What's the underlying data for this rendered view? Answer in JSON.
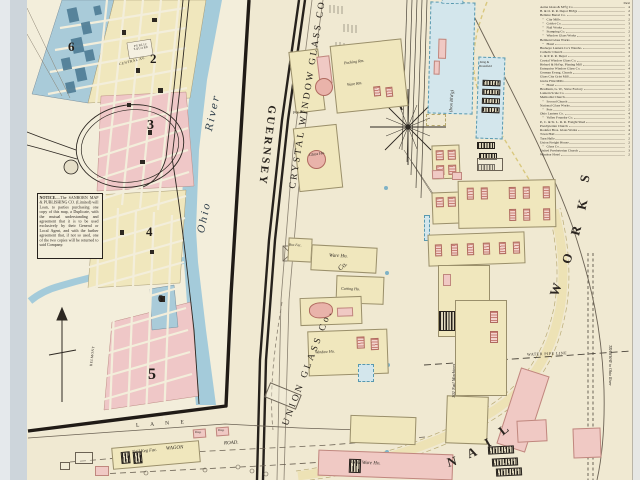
{
  "page": {
    "description": "Sanborn fire insurance map sheet, riverside industrial town with glass and nail works"
  },
  "index": {
    "header": "Sheet",
    "entries": [
      {
        "n": "Aetna Glass & M'f'g Co.",
        "s": "4"
      },
      {
        "n": "B. & O. R. R. Depot Bld'gs",
        "s": "2"
      },
      {
        "n": "Bellaire Barrel Co.",
        "s": "3"
      },
      {
        "n": "   ″   City Mills",
        "s": "2"
      },
      {
        "n": "   ″   Goblet Co.",
        "s": "3"
      },
      {
        "n": "   ″   Nail Works",
        "s": "1"
      },
      {
        "n": "   ″   Stamping Co.",
        "s": "2"
      },
      {
        "n": "   ″   Window Glass Works",
        "s": "1"
      },
      {
        "n": "Belmont Glass Works",
        "s": "2"
      },
      {
        "n": "   ″   Hotel",
        "s": "2"
      },
      {
        "n": "Buckeye Lantern Co's Wareho.",
        "s": "3"
      },
      {
        "n": "Catholic Church",
        "s": "3"
      },
      {
        "n": "C. & P. R. R. Depot",
        "s": "2"
      },
      {
        "n": "Crystal Window Glass Co.",
        "s": "1"
      },
      {
        "n": "Hebard & Hol'sp. Planing Mill",
        "s": "2"
      },
      {
        "n": "Enterprise Window Glass Co.",
        "s": "4"
      },
      {
        "n": "German Evang. Church",
        "s": "3"
      },
      {
        "n": "Glass City Grist Mill",
        "s": "2"
      },
      {
        "n": "Globe Flint Mills",
        "s": "3"
      },
      {
        "n": "   ″   Hotel",
        "s": "2"
      },
      {
        "n": "Bradburn, G. W., Stave Factory",
        "s": "3"
      },
      {
        "n": "Lantern Scale Co.",
        "s": "3"
      },
      {
        "n": "Methodist Church",
        "s": "3"
      },
      {
        "n": "   ″   Second Church",
        "s": "3"
      },
      {
        "n": "National Glass Works",
        "s": "2"
      },
      {
        "n": "   ″   Pots",
        "s": "2"
      },
      {
        "n": "Ohio Lantern Co.",
        "s": "4"
      },
      {
        "n": "   ″   Valley Foundry Co.",
        "s": "3"
      },
      {
        "n": "P., C. & St. L. R. R. Freight Shed",
        "s": "2"
      },
      {
        "n": "Presbyterian Church",
        "s": "3"
      },
      {
        "n": "Rodefer Bros. Glass Works",
        "s": "4"
      },
      {
        "n": "Town Hall",
        "s": "2"
      },
      {
        "n": "Turn Halle",
        "s": "2"
      },
      {
        "n": "Union Freight House",
        "s": "2"
      },
      {
        "n": "   ″   Glass Co.",
        "s": "1"
      },
      {
        "n": "United Presbyterian Church",
        "s": "3"
      },
      {
        "n": "Windsor Hotel",
        "s": "2"
      }
    ]
  },
  "notice": {
    "title": "NOTICE.",
    "body": "—The SANBORN MAP & PUBLISHING CO. (Limited) will Loan, to parties purchasing one copy of this map, a Duplicate, with the mutual understanding and agreement that it is to be used exclusively by their General or Local Agent, and with the further agreement that, if not so used, one of the two copies will be returned to said Company."
  },
  "inset": {
    "numbers": {
      "d6": "6",
      "d2": "2",
      "d3": "3",
      "d4": "4",
      "d5": "5",
      "d6b": "6"
    },
    "public_square": "PUBLIC SQUARE",
    "river_word1": "Ohio",
    "river_word2": "River",
    "central_av": "CENTRAL AV.",
    "belmont": "BELMONT",
    "lane": "L A N E"
  },
  "roads": {
    "guernsey": "GUERNSEY",
    "wagon": "WAGON",
    "road": "ROAD.",
    "water_pipe": "WATER PIPE LINE",
    "tramway": "TRAMWAY to Ohio River"
  },
  "works": {
    "crystal": "CRYSTAL WINDOW GLASS CO.",
    "union": "UNION GLASS Co.",
    "nail": [
      "N",
      "A",
      "I",
      "L"
    ],
    "works_word": [
      "W",
      "O",
      "R",
      "K",
      "S"
    ]
  },
  "labels": {
    "pot_ho": "Pot Ho.",
    "glass_ho": "Glass Ho.",
    "packing_rm": "Packing Rm.",
    "ware_rm": "Ware Rm.",
    "ware_ho": "Ware Ho.",
    "box_fac": "Box Fac.",
    "cutting_ho": "Cutting Ho.",
    "window_ho": "Window Ho.",
    "co": "Co.",
    "iron_bldg": "(Iron Bl'd'g)",
    "king1": "King &",
    "king2": "Dronsfield",
    "nail_machines": "102 Nail Machines",
    "nail_ware_ho": "Nail Ware Ho.",
    "nail_keg_fac": "Nail Keg Fac.",
    "dwg": "Dwg."
  },
  "colors": {
    "paper": "#f0e9d2",
    "inset_paper": "#f3eedb",
    "building_yellow": "#f0e7bd",
    "building_pink": "#f0c9c4",
    "district_blue": "#a9cbd9",
    "river_blue": "#a4cbda",
    "iron_building_blue": "#d3e6ec",
    "ink": "#2d2822",
    "road_yellow": "#d9c87e"
  }
}
